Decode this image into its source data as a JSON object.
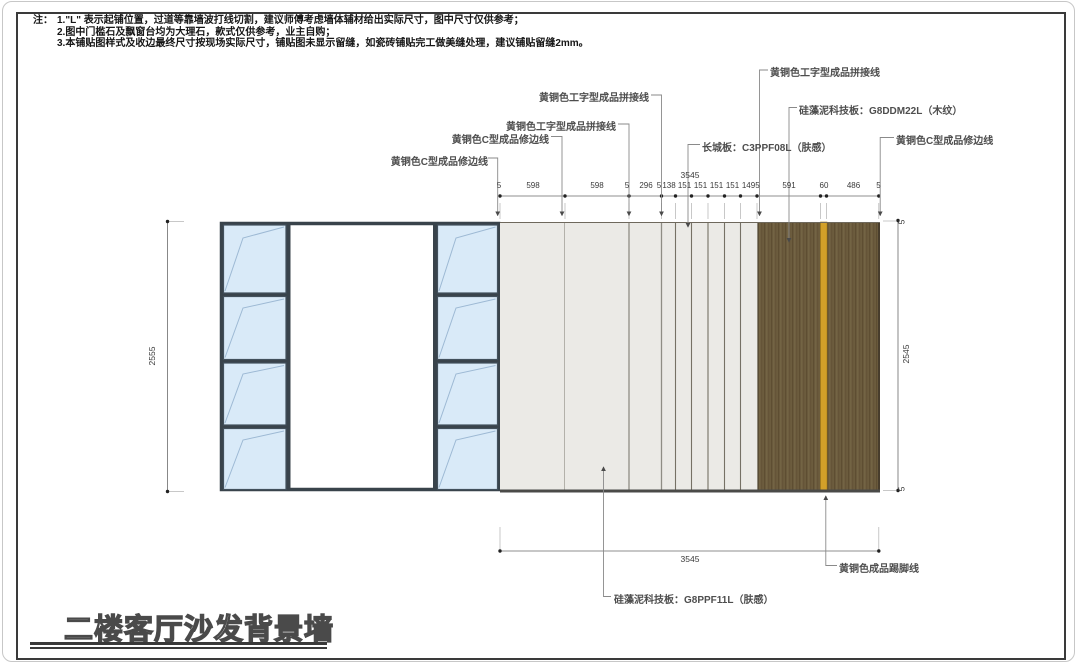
{
  "sheet": {
    "title_block": "二楼客厅沙发背景墙"
  },
  "notes": {
    "prefix": "注：",
    "line1": "1.\"L\" 表示起铺位置，过道等靠墙波打线切割，建议师傅考虑墙体辅材给出实际尺寸，图中尺寸仅供参考；",
    "line2": "2.图中门槛石及飘窗台均为大理石，款式仅供参考，业主自购；",
    "line3": "3.本铺贴图样式及收边最终尺寸按现场实际尺寸，铺贴图未显示留缝，如瓷砖铺贴完工做美缝处理，建议铺贴留缝2mm。"
  },
  "callouts": {
    "c_edge_left": "黄铜色C型成品修边线",
    "c_edge_mid": "黄铜色C型成品修边线",
    "i_joint_mid": "黄铜色工字型成品拼接线",
    "i_joint_left": "黄铜色工字型成品拼接线",
    "i_joint_right": "黄铜色工字型成品拼接线",
    "diatom_wood": "硅藻泥科技板：G8DDM22L（木纹）",
    "great_wall_board": "长城板：C3PPF08L（肤感）",
    "c_edge_right": "黄铜色C型成品修边线",
    "diatom_skin": "硅藻泥科技板：G8PPF11L（肤感）",
    "skirting": "黄铜色成品踢脚线"
  },
  "dimensions": {
    "top_total": "3545",
    "top_segments": [
      "5",
      "598",
      "598",
      "5",
      "296",
      "5",
      "138",
      "151",
      "151",
      "151",
      "151",
      "149",
      "5",
      "591",
      "60",
      "486",
      "5"
    ],
    "bottom_total": "3545",
    "left_height": "2555",
    "right_height": "2545",
    "right_top_seg": "5",
    "right_bottom_seg": "5"
  },
  "materials": {
    "glass_color": "#d9eaf8",
    "frame_color": "#39434b",
    "panel_gray": "#ebeae6",
    "wood_color": "#6c5c3e",
    "brass_color": "#d2a029",
    "leader_color": "#8a8a8a"
  }
}
